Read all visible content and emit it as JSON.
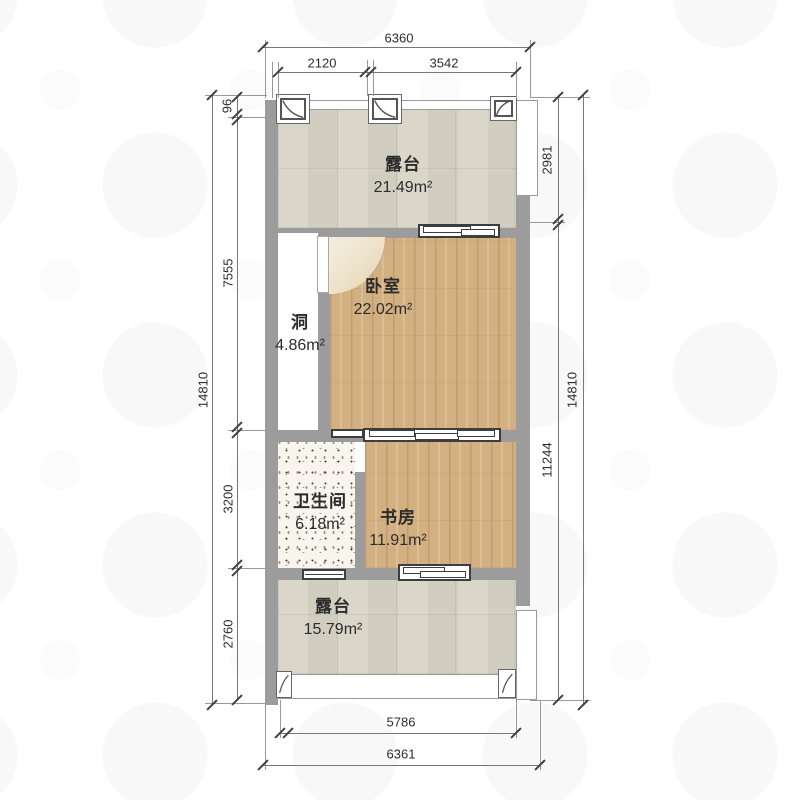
{
  "plan": {
    "rooms": [
      {
        "id": "terrace-top",
        "name": "露台",
        "area": "21.49m²"
      },
      {
        "id": "bedroom",
        "name": "卧室",
        "area": "22.02m²"
      },
      {
        "id": "hole",
        "name": "洞",
        "area": "4.86m²"
      },
      {
        "id": "bathroom",
        "name": "卫生间",
        "area": "6.18m²"
      },
      {
        "id": "study",
        "name": "书房",
        "area": "11.91m²"
      },
      {
        "id": "terrace-bottom",
        "name": "露台",
        "area": "15.79m²"
      }
    ],
    "dims": {
      "top_total": "6360",
      "top_a": "2120",
      "top_b": "3542",
      "left_total": "14810",
      "left_a": "96",
      "left_b": "7555",
      "left_c": "3200",
      "left_d": "2760",
      "right_a": "2981",
      "right_b": "11244",
      "right_total": "14810",
      "bottom_inner": "5786",
      "bottom_total": "6361"
    },
    "colors": {
      "wall": "#9c9c9c",
      "wood_floor": "#d3b082",
      "terrace_floor": "#d7d4c6",
      "bath_floor": "#f8f5ee"
    }
  }
}
